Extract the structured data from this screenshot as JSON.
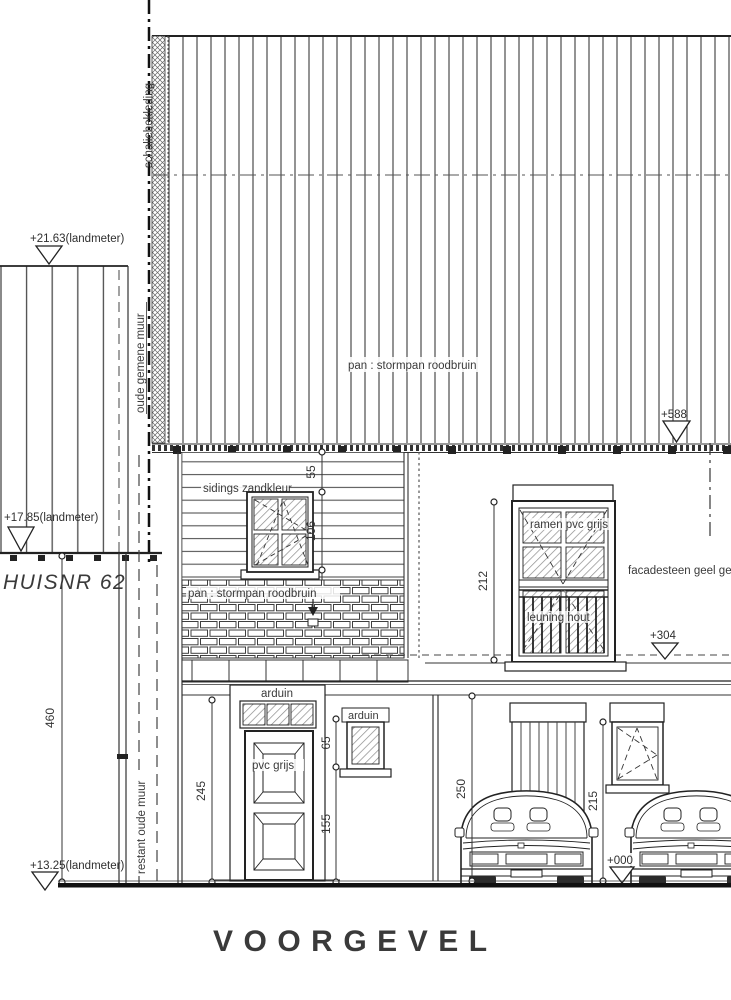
{
  "drawing_title": "VOORGEVEL",
  "house_label": "HUISNR 62",
  "annotations": {
    "schaliebekleding": "schaliebekleding",
    "oude_gemene_muur": "oude gemene muur",
    "roof_material": "pan : stormpan roodbruin",
    "siding_material": "sidings zandkleur",
    "brick_material": "pan : stormpan roodbruin",
    "ramen_pvc": "ramen pvc grijs",
    "leuning_hout": "leuning hout",
    "facadesteen": "facadesteen geel ge",
    "arduin_door": "arduin",
    "arduin_window": "arduin",
    "pvc_grijs": "pvc grijs",
    "restant_oude_muur": "restant oude muur"
  },
  "levels": {
    "neighbor_ridge": "+21.63(landmeter)",
    "neighbor_eaves": "+17.85(landmeter)",
    "neighbor_base": "+13.25(landmeter)",
    "main_eaves": "+588",
    "first_floor": "+304",
    "ground": "+000"
  },
  "dimensions": {
    "attic_eaves_to_window": "55",
    "attic_window_height": "106",
    "tall_window_height": "212",
    "neighbor_wall_height": "460",
    "door_height": "245",
    "side_window_height": "65",
    "side_window_sill": "155",
    "garage_opening_height": "250",
    "rear_opening_height": "215"
  },
  "line_colors": {
    "main": "#2b2b2b",
    "light": "#555555",
    "hatch": "#8a8a8a"
  }
}
